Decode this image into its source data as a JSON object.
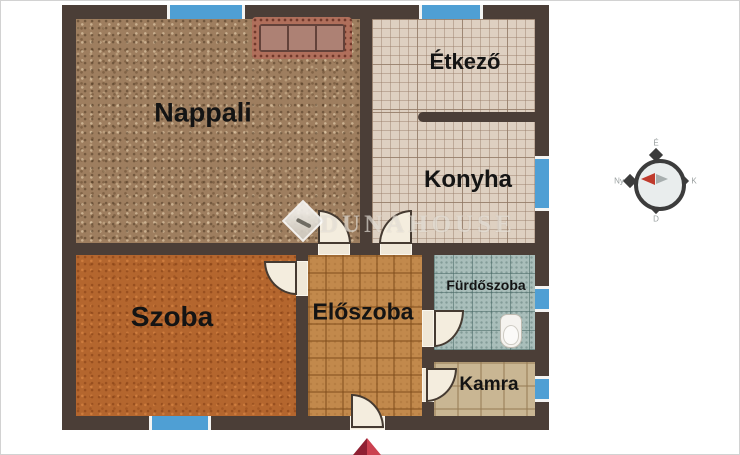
{
  "watermark": {
    "text": "DUNAHOUSE"
  },
  "rooms": [
    {
      "id": "nappali",
      "label": "Nappali"
    },
    {
      "id": "etkezo",
      "label": "Étkező"
    },
    {
      "id": "konyha",
      "label": "Konyha"
    },
    {
      "id": "szoba",
      "label": "Szoba"
    },
    {
      "id": "eloszoba",
      "label": "Előszoba"
    },
    {
      "id": "furdoszoba",
      "label": "Fürdőszoba"
    },
    {
      "id": "kamra",
      "label": "Kamra"
    }
  ],
  "compass": {
    "north": "É",
    "east": "K",
    "south": "D",
    "west": "Ny"
  },
  "colors": {
    "wall": "#4b3e37",
    "window": "#4f9fd4",
    "nappali_floor": "#9e7e5f",
    "szoba_floor": "#b4662e",
    "tile_floor": "#ded0c1",
    "eloszoba_floor": "#c2894c",
    "furdoszoba_floor": "#a9beba",
    "kamra_floor": "#c9b693",
    "entrance_marker": "#b22a3d"
  }
}
